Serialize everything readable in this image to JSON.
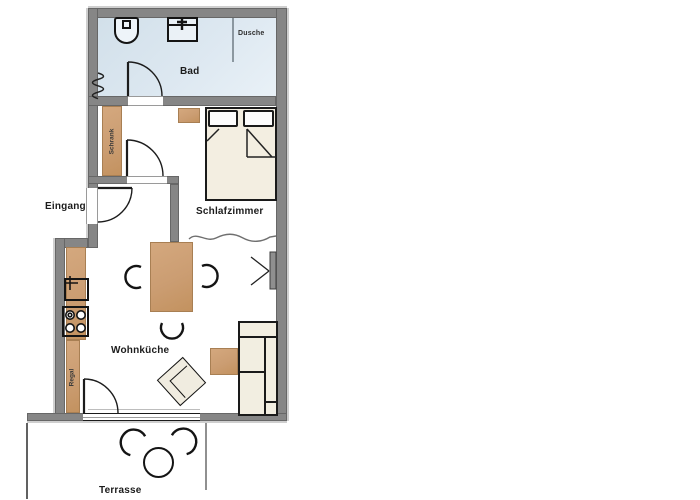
{
  "plan_type": "apartment-floorplan",
  "rooms": {
    "bad": {
      "label": "Bad"
    },
    "dusche": {
      "label": "Dusche"
    },
    "eingang": {
      "label": "Eingang"
    },
    "schlafzimmer": {
      "label": "Schlafzimmer"
    },
    "wohnkueche": {
      "label": "Wohnküche"
    },
    "terrasse": {
      "label": "Terrasse"
    }
  },
  "fixtures": {
    "schrank": {
      "label": "Schrank"
    },
    "regal": {
      "label": "Regal"
    }
  },
  "furniture_symbols": [
    "toilet",
    "washbasin",
    "radiator",
    "shower-partition",
    "double-bed",
    "pillows",
    "wardrobe",
    "dresser",
    "kitchen-sink",
    "stove",
    "shelf",
    "dining-table",
    "dining-chairs",
    "armchair",
    "sofa",
    "side-table",
    "window-tilt-symbol",
    "curtain-divider",
    "terrace-table",
    "terrace-chairs"
  ],
  "colors": {
    "wall": "#868686",
    "wall_highlight": "#cfcfcf",
    "bath_floor": "#dbe7f0",
    "wood": "#cda177",
    "fabric": "#f2eee1",
    "outline": "#1a1a1a"
  }
}
